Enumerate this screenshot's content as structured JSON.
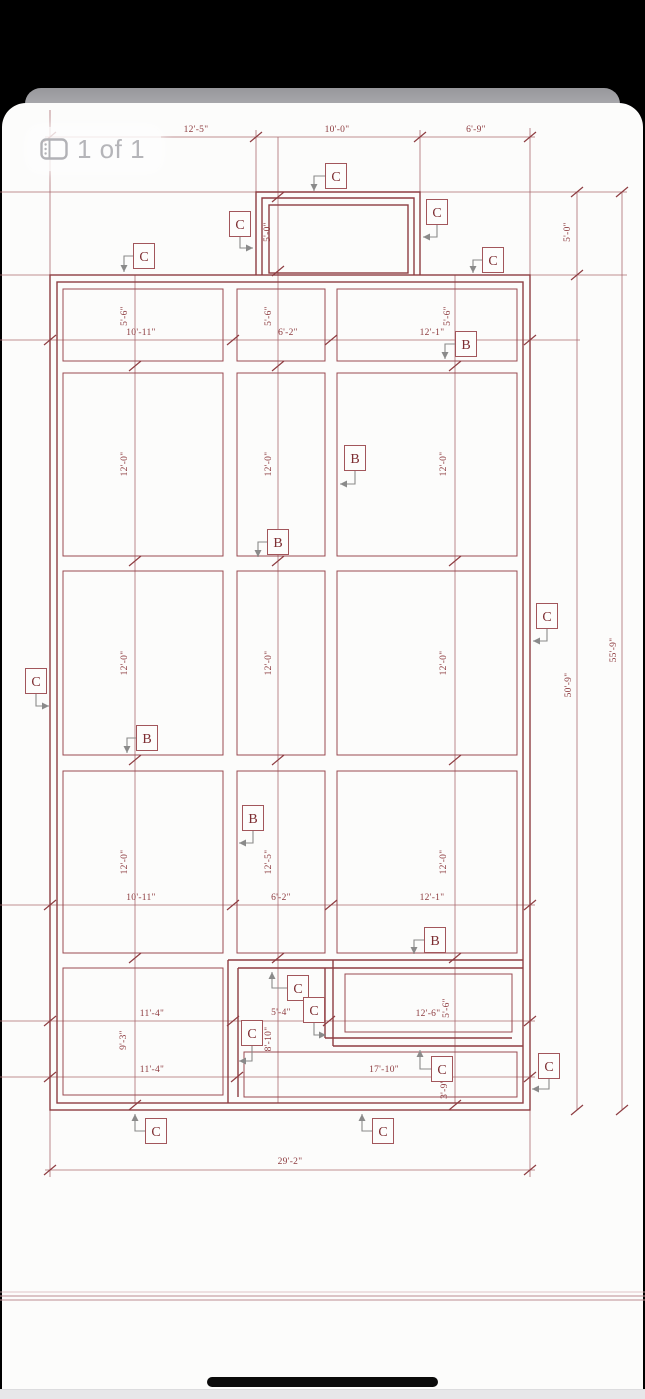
{
  "viewer": {
    "page_indicator": "1 of 1"
  },
  "colors": {
    "plan_line": "#8e3d42",
    "dim_line": "#aa6b70",
    "dim_text": "#8d3b3f",
    "leader_gray": "#8a8a8a",
    "background": "#fcfcfb",
    "chrome_black": "#000000"
  },
  "drawing": {
    "dimension_labels": [
      {
        "text": "12'-5\"",
        "x": 196,
        "y": 132,
        "rot": 0
      },
      {
        "text": "10'-0\"",
        "x": 337,
        "y": 132,
        "rot": 0
      },
      {
        "text": "6'-9\"",
        "x": 476,
        "y": 132,
        "rot": 0
      },
      {
        "text": "5'-0\"",
        "x": 270,
        "y": 232,
        "rot": -90
      },
      {
        "text": "5'-0\"",
        "x": 570,
        "y": 232,
        "rot": -90
      },
      {
        "text": "5'-6\"",
        "x": 127,
        "y": 316,
        "rot": -90
      },
      {
        "text": "10'-11\"",
        "x": 141,
        "y": 335,
        "rot": 0
      },
      {
        "text": "5'-6\"",
        "x": 271,
        "y": 316,
        "rot": -90
      },
      {
        "text": "6'-2\"",
        "x": 288,
        "y": 335,
        "rot": 0
      },
      {
        "text": "5'-6\"",
        "x": 450,
        "y": 316,
        "rot": -90
      },
      {
        "text": "12'-1\"",
        "x": 432,
        "y": 335,
        "rot": 0
      },
      {
        "text": "12'-0\"",
        "x": 127,
        "y": 464,
        "rot": -90
      },
      {
        "text": "12'-0\"",
        "x": 271,
        "y": 464,
        "rot": -90
      },
      {
        "text": "12'-0\"",
        "x": 446,
        "y": 464,
        "rot": -90
      },
      {
        "text": "12'-0\"",
        "x": 127,
        "y": 663,
        "rot": -90
      },
      {
        "text": "12'-0\"",
        "x": 271,
        "y": 663,
        "rot": -90
      },
      {
        "text": "12'-0\"",
        "x": 446,
        "y": 663,
        "rot": -90
      },
      {
        "text": "50'-9\"",
        "x": 571,
        "y": 685,
        "rot": -90
      },
      {
        "text": "55'-9\"",
        "x": 616,
        "y": 650,
        "rot": -90
      },
      {
        "text": "12'-0\"",
        "x": 127,
        "y": 862,
        "rot": -90
      },
      {
        "text": "12'-5\"",
        "x": 271,
        "y": 862,
        "rot": -90
      },
      {
        "text": "12'-0\"",
        "x": 446,
        "y": 862,
        "rot": -90
      },
      {
        "text": "10'-11\"",
        "x": 141,
        "y": 900,
        "rot": 0
      },
      {
        "text": "6'-2\"",
        "x": 281,
        "y": 900,
        "rot": 0
      },
      {
        "text": "12'-1\"",
        "x": 432,
        "y": 900,
        "rot": 0
      },
      {
        "text": "11'-4\"",
        "x": 152,
        "y": 1016,
        "rot": 0
      },
      {
        "text": "5'-4\"",
        "x": 281,
        "y": 1015,
        "rot": 0
      },
      {
        "text": "12'-6\"",
        "x": 428,
        "y": 1016,
        "rot": 0
      },
      {
        "text": "5'-6\"",
        "x": 449,
        "y": 1008,
        "rot": -90
      },
      {
        "text": "9'-3\"",
        "x": 126,
        "y": 1040,
        "rot": -90
      },
      {
        "text": "8'-10\"",
        "x": 271,
        "y": 1039,
        "rot": -90
      },
      {
        "text": "11'-4\"",
        "x": 152,
        "y": 1072,
        "rot": 0
      },
      {
        "text": "17'-10\"",
        "x": 384,
        "y": 1072,
        "rot": 0
      },
      {
        "text": "3'-9\"",
        "x": 447,
        "y": 1089,
        "rot": -90
      },
      {
        "text": "29'-2\"",
        "x": 290,
        "y": 1164,
        "rot": 0
      }
    ],
    "callouts": [
      {
        "letter": "C",
        "x": 336,
        "y": 176,
        "pts": [
          [
            325,
            176
          ],
          [
            314,
            176
          ],
          [
            314,
            191
          ]
        ],
        "dir": "down"
      },
      {
        "letter": "C",
        "x": 240,
        "y": 224,
        "pts": [
          [
            240,
            237
          ],
          [
            240,
            248
          ],
          [
            253,
            248
          ]
        ],
        "dir": "right"
      },
      {
        "letter": "C",
        "x": 437,
        "y": 212,
        "pts": [
          [
            437,
            225
          ],
          [
            437,
            237
          ],
          [
            423,
            237
          ]
        ],
        "dir": "left"
      },
      {
        "letter": "C",
        "x": 144,
        "y": 256,
        "pts": [
          [
            133,
            256
          ],
          [
            124,
            256
          ],
          [
            124,
            272
          ]
        ],
        "dir": "down"
      },
      {
        "letter": "C",
        "x": 493,
        "y": 260,
        "pts": [
          [
            482,
            260
          ],
          [
            473,
            260
          ],
          [
            473,
            273
          ]
        ],
        "dir": "down"
      },
      {
        "letter": "C",
        "x": 36,
        "y": 681,
        "pts": [
          [
            36,
            694
          ],
          [
            36,
            706
          ],
          [
            49,
            706
          ]
        ],
        "dir": "right"
      },
      {
        "letter": "C",
        "x": 547,
        "y": 616,
        "pts": [
          [
            547,
            629
          ],
          [
            547,
            641
          ],
          [
            533,
            641
          ]
        ],
        "dir": "left"
      },
      {
        "letter": "C",
        "x": 298,
        "y": 988,
        "pts": [
          [
            287,
            988
          ],
          [
            272,
            988
          ],
          [
            272,
            972
          ]
        ],
        "dir": "up"
      },
      {
        "letter": "C",
        "x": 314,
        "y": 1010,
        "pts": [
          [
            314,
            1023
          ],
          [
            314,
            1035
          ],
          [
            326,
            1035
          ]
        ],
        "dir": "right"
      },
      {
        "letter": "C",
        "x": 252,
        "y": 1033,
        "pts": [
          [
            252,
            1046
          ],
          [
            252,
            1061
          ],
          [
            239,
            1061
          ]
        ],
        "dir": "left"
      },
      {
        "letter": "C",
        "x": 442,
        "y": 1069,
        "pts": [
          [
            431,
            1069
          ],
          [
            420,
            1069
          ],
          [
            420,
            1050
          ]
        ],
        "dir": "up"
      },
      {
        "letter": "C",
        "x": 549,
        "y": 1066,
        "pts": [
          [
            549,
            1079
          ],
          [
            549,
            1089
          ],
          [
            532,
            1089
          ]
        ],
        "dir": "left"
      },
      {
        "letter": "C",
        "x": 156,
        "y": 1131,
        "pts": [
          [
            145,
            1131
          ],
          [
            135,
            1131
          ],
          [
            135,
            1114
          ]
        ],
        "dir": "up"
      },
      {
        "letter": "C",
        "x": 383,
        "y": 1131,
        "pts": [
          [
            372,
            1131
          ],
          [
            362,
            1131
          ],
          [
            362,
            1114
          ]
        ],
        "dir": "up"
      },
      {
        "letter": "B",
        "x": 466,
        "y": 344,
        "pts": [
          [
            455,
            344
          ],
          [
            445,
            344
          ],
          [
            445,
            359
          ]
        ],
        "dir": "down"
      },
      {
        "letter": "B",
        "x": 355,
        "y": 458,
        "pts": [
          [
            355,
            471
          ],
          [
            355,
            484
          ],
          [
            340,
            484
          ]
        ],
        "dir": "left"
      },
      {
        "letter": "B",
        "x": 278,
        "y": 542,
        "pts": [
          [
            267,
            542
          ],
          [
            258,
            542
          ],
          [
            258,
            557
          ]
        ],
        "dir": "down"
      },
      {
        "letter": "B",
        "x": 147,
        "y": 738,
        "pts": [
          [
            136,
            738
          ],
          [
            127,
            738
          ],
          [
            127,
            753
          ]
        ],
        "dir": "down"
      },
      {
        "letter": "B",
        "x": 253,
        "y": 818,
        "pts": [
          [
            253,
            831
          ],
          [
            253,
            843
          ],
          [
            239,
            843
          ]
        ],
        "dir": "left"
      },
      {
        "letter": "B",
        "x": 435,
        "y": 940,
        "pts": [
          [
            424,
            940
          ],
          [
            414,
            940
          ],
          [
            414,
            954
          ]
        ],
        "dir": "down"
      }
    ]
  }
}
